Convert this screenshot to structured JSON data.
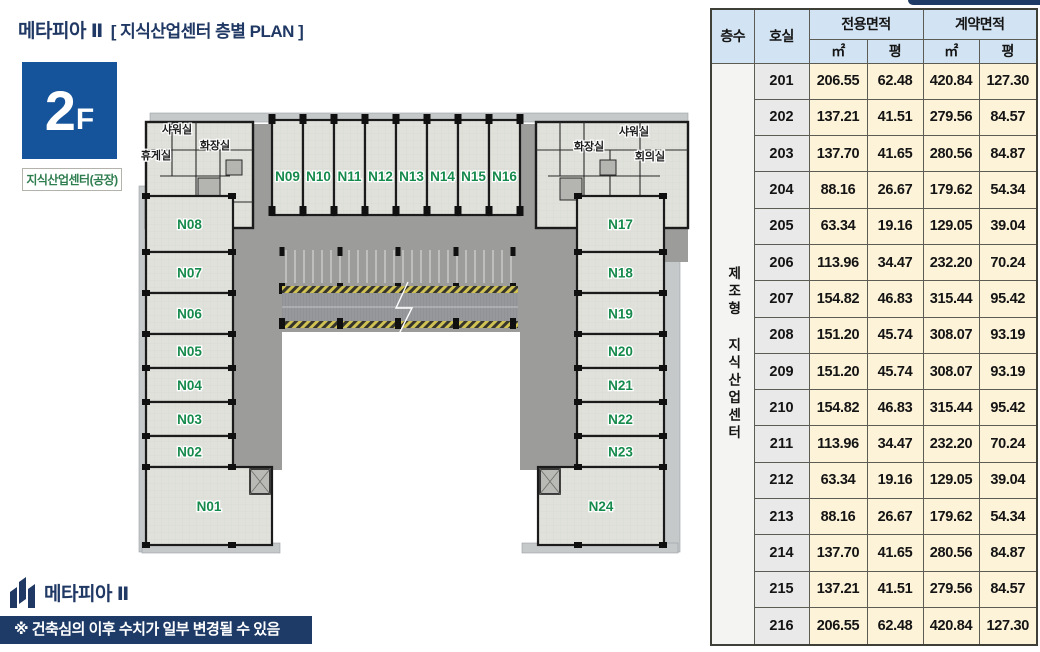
{
  "header": {
    "title_brand": "메타피아 Ⅱ",
    "title_rest": "[ 지식산업센터 층별 PLAN ]",
    "floor_number": "2",
    "floor_suffix": "F",
    "building_type": "지식산업센터(공장)"
  },
  "plan": {
    "units_top": [
      "N09",
      "N10",
      "N11",
      "N12",
      "N13",
      "N14",
      "N15",
      "N16"
    ],
    "left_wing": [
      "N08",
      "N07",
      "N06",
      "N05",
      "N04",
      "N03",
      "N02",
      "N01"
    ],
    "right_wing": [
      "N17",
      "N18",
      "N19",
      "N20",
      "N21",
      "N22",
      "N23",
      "N24"
    ],
    "facilities_left": [
      "샤워실",
      "화장실",
      "휴게실"
    ],
    "facilities_right": [
      "화장실",
      "샤워실",
      "회의실"
    ]
  },
  "table": {
    "col_floor": "층수",
    "col_room": "호실",
    "col_exclusive": "전용면적",
    "col_contract": "계약면적",
    "unit_m2": "㎡",
    "unit_pyeong": "평",
    "floor_label_vertical": "제조형 지식산업센터",
    "rows": [
      {
        "room": "201",
        "ex_m2": "206.55",
        "ex_py": "62.48",
        "ct_m2": "420.84",
        "ct_py": "127.30"
      },
      {
        "room": "202",
        "ex_m2": "137.21",
        "ex_py": "41.51",
        "ct_m2": "279.56",
        "ct_py": "84.57"
      },
      {
        "room": "203",
        "ex_m2": "137.70",
        "ex_py": "41.65",
        "ct_m2": "280.56",
        "ct_py": "84.87"
      },
      {
        "room": "204",
        "ex_m2": "88.16",
        "ex_py": "26.67",
        "ct_m2": "179.62",
        "ct_py": "54.34"
      },
      {
        "room": "205",
        "ex_m2": "63.34",
        "ex_py": "19.16",
        "ct_m2": "129.05",
        "ct_py": "39.04"
      },
      {
        "room": "206",
        "ex_m2": "113.96",
        "ex_py": "34.47",
        "ct_m2": "232.20",
        "ct_py": "70.24"
      },
      {
        "room": "207",
        "ex_m2": "154.82",
        "ex_py": "46.83",
        "ct_m2": "315.44",
        "ct_py": "95.42"
      },
      {
        "room": "208",
        "ex_m2": "151.20",
        "ex_py": "45.74",
        "ct_m2": "308.07",
        "ct_py": "93.19"
      },
      {
        "room": "209",
        "ex_m2": "151.20",
        "ex_py": "45.74",
        "ct_m2": "308.07",
        "ct_py": "93.19"
      },
      {
        "room": "210",
        "ex_m2": "154.82",
        "ex_py": "46.83",
        "ct_m2": "315.44",
        "ct_py": "95.42"
      },
      {
        "room": "211",
        "ex_m2": "113.96",
        "ex_py": "34.47",
        "ct_m2": "232.20",
        "ct_py": "70.24"
      },
      {
        "room": "212",
        "ex_m2": "63.34",
        "ex_py": "19.16",
        "ct_m2": "129.05",
        "ct_py": "39.04"
      },
      {
        "room": "213",
        "ex_m2": "88.16",
        "ex_py": "26.67",
        "ct_m2": "179.62",
        "ct_py": "54.34"
      },
      {
        "room": "214",
        "ex_m2": "137.70",
        "ex_py": "41.65",
        "ct_m2": "280.56",
        "ct_py": "84.87"
      },
      {
        "room": "215",
        "ex_m2": "137.21",
        "ex_py": "41.51",
        "ct_m2": "279.56",
        "ct_py": "84.57"
      },
      {
        "room": "216",
        "ex_m2": "206.55",
        "ex_py": "62.48",
        "ct_m2": "420.84",
        "ct_py": "127.30"
      }
    ]
  },
  "footer": {
    "logo_text": "메타피아 Ⅱ",
    "disclaimer": "※ 건축심의 이후 수치가 일부 변경될 수 있음"
  },
  "colors": {
    "navy": "#1e3a66",
    "title_navy": "#203864",
    "badge_blue": "#15549b",
    "room_label_green": "#168a4c",
    "type_green": "#2e7d4f",
    "table_header_blue": "#d2e4f3",
    "table_cream": "#fdf3d9",
    "table_gray": "#e9e9e9",
    "corridor_gray": "#9c9c9a",
    "floor_gray": "#e0e1db",
    "wall_black": "#1b1b1b",
    "hatch_yellow": "#cfc153"
  }
}
